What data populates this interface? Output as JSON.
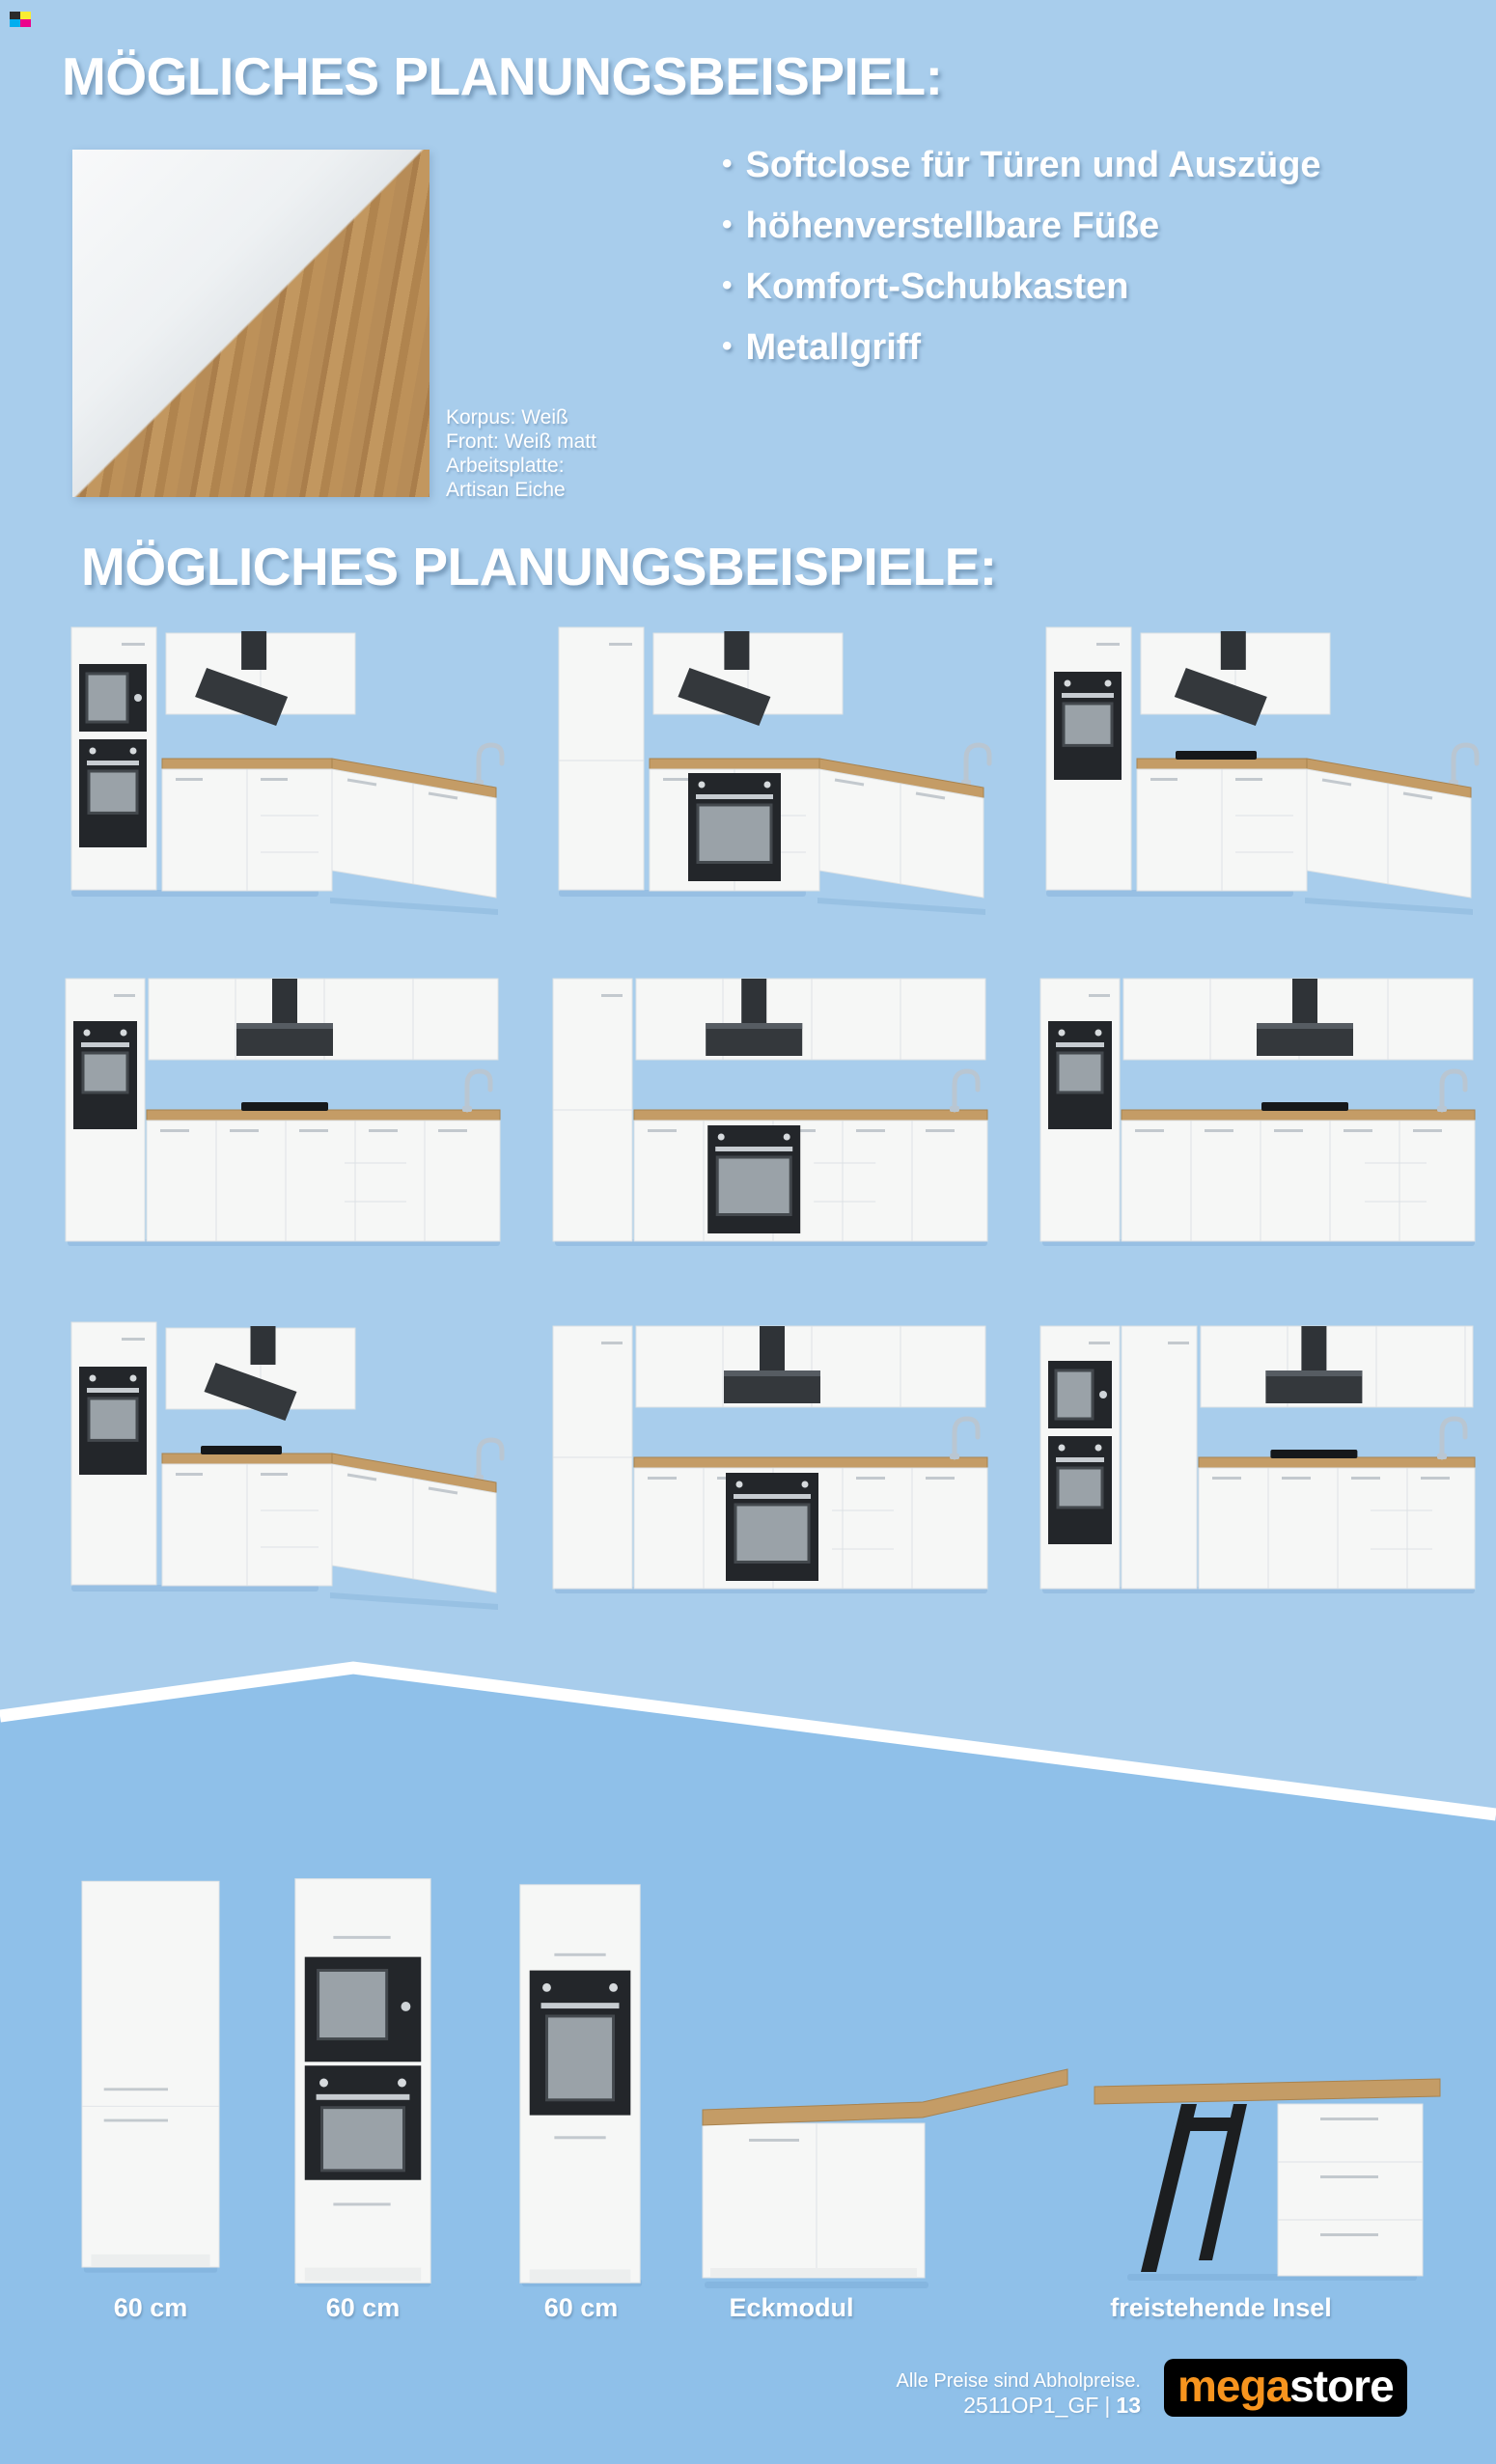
{
  "page": {
    "bg_top": "#a8cdec",
    "bg_bottom": "#8fc0e9",
    "divider_line": "#ffffff"
  },
  "print_mark": {
    "colors": [
      "#2b2b2b",
      "#f9ed32",
      "#00aeef",
      "#ec008c"
    ]
  },
  "heading1": "MÖGLICHES PLANUNGSBEISPIEL:",
  "heading2": "MÖGLICHES PLANUNGSBEISPIELE:",
  "bullet": "•",
  "features": [
    "Softclose für Türen und Auszüge",
    "höhenverstellbare Füße",
    "Komfort-Schubkasten",
    "Metallgriff"
  ],
  "material": {
    "lines": [
      "Korpus: Weiß",
      "Front: Weiß matt",
      "Arbeitsplatte:",
      "Artisan Eiche"
    ],
    "swatch_white": "#f4f5f6",
    "swatch_wood": "#b78c57"
  },
  "kitchens": [
    {
      "name": "kitchen-example-1",
      "type": "corner",
      "tall": "mw-oven",
      "base_oven": false,
      "hob": false,
      "hood": 0.43
    },
    {
      "name": "kitchen-example-2",
      "type": "corner",
      "tall": "none",
      "base_oven": true,
      "hob": false,
      "hood": 0.42
    },
    {
      "name": "kitchen-example-3",
      "type": "corner",
      "tall": "oven",
      "base_oven": false,
      "hob": true,
      "hood": 0.44
    },
    {
      "name": "kitchen-example-4",
      "type": "straight",
      "tall": "oven",
      "base_oven": false,
      "hob": true,
      "hood": 0.5
    },
    {
      "name": "kitchen-example-5",
      "type": "straight",
      "tall": "none",
      "base_oven": true,
      "hob": false,
      "hood": 0.46
    },
    {
      "name": "kitchen-example-6",
      "type": "straight",
      "tall": "oven",
      "base_oven": false,
      "hob": true,
      "hood": 0.6
    },
    {
      "name": "kitchen-example-7",
      "type": "corner",
      "tall": "oven",
      "base_oven": false,
      "hob": true,
      "hood": 0.45
    },
    {
      "name": "kitchen-example-8",
      "type": "straight",
      "tall": "none",
      "base_oven": true,
      "hob": false,
      "hood": 0.5
    },
    {
      "name": "kitchen-example-9",
      "type": "straight",
      "tall": "mw-oven",
      "extra_tall": true,
      "base_oven": false,
      "hob": true,
      "hood": 0.62
    }
  ],
  "bottom_units": [
    {
      "label": "60 cm",
      "type": "fridge-tower"
    },
    {
      "label": "60 cm",
      "type": "mw-oven-tower"
    },
    {
      "label": "60 cm",
      "type": "oven-tower"
    },
    {
      "label": "Eckmodul",
      "type": "corner-module"
    },
    {
      "label": "freistehende Insel",
      "type": "island"
    }
  ],
  "footer": {
    "note": "Alle Preise sind Abholpreise.",
    "code": "2511OP1_GF",
    "divider": "|",
    "page_number": "13"
  },
  "logo": {
    "part1": "mega",
    "part2": "store",
    "part1_color": "#f7941e",
    "part2_color": "#ffffff",
    "bg": "#000000"
  }
}
